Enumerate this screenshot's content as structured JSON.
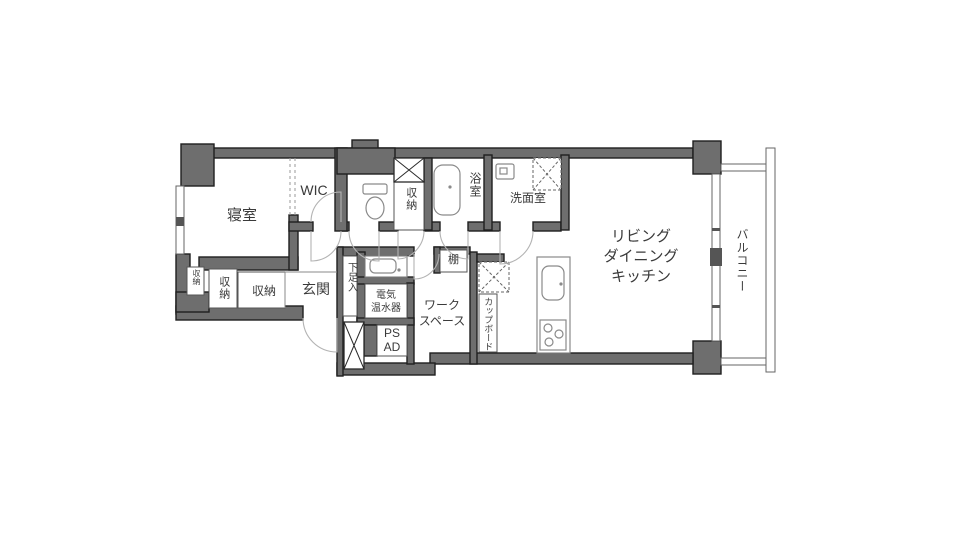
{
  "figure": "apartment-floor-plan",
  "colors": {
    "wall_fill": "#6e6e6e",
    "wall_outline": "#1f1f1f",
    "fixture_line": "#8a8a8a",
    "door_arc": "#b3b3b3",
    "text": "#3a3a3a",
    "background": "#ffffff"
  },
  "rooms": {
    "bedroom": {
      "label": "寝室"
    },
    "wic": {
      "label": "WIC"
    },
    "hall_storage": {
      "label": "収納"
    },
    "bathroom": {
      "label": "浴室"
    },
    "washroom": {
      "label": "洗面室"
    },
    "ldk": {
      "lines": [
        "リビング",
        "ダイニング",
        "キッチン"
      ]
    },
    "balcony": {
      "label": "バルコニー"
    },
    "entrance": {
      "label": "玄関"
    },
    "entrance_storage": {
      "label": "収納"
    },
    "bedroom_storage": {
      "label": "収納"
    },
    "corner_storage": {
      "label": "収納"
    },
    "shoe_cabinet": {
      "label": "下足入"
    },
    "water_heater": {
      "line1": "電気",
      "line2": "温水器"
    },
    "pipe_space": {
      "label": "PS"
    },
    "air_duct": {
      "label": "AD"
    },
    "workspace": {
      "line1": "ワーク",
      "line2": "スペース"
    },
    "shelf": {
      "label": "棚"
    },
    "cupboard": {
      "label": "カップボード"
    }
  },
  "fixture_icons": [
    "toilet-icon",
    "bathtub-icon",
    "washbasin-icon",
    "hall-washbasin-icon",
    "washing-machine-area-icon",
    "refrigerator-area-icon",
    "kitchen-sink-icon",
    "stove-icon",
    "shaft-x-icon",
    "meter-box-x-icon",
    "door-swing-arcs",
    "window-glyphs",
    "balcony-rail"
  ]
}
